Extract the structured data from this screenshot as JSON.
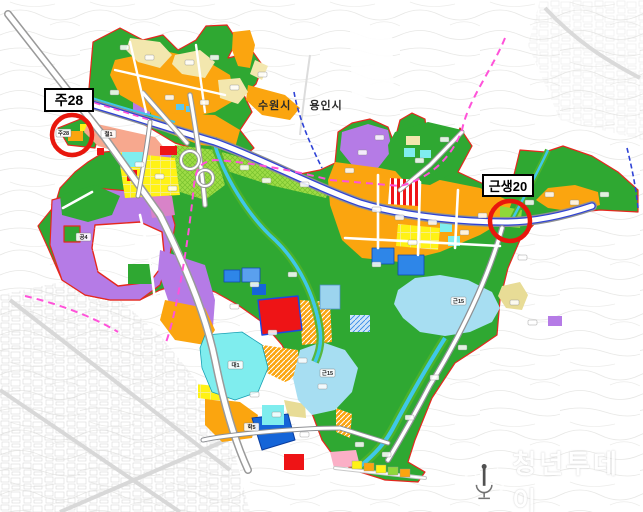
{
  "callouts": {
    "ju28": {
      "label": "주28"
    },
    "geunsaeng20": {
      "label": "근생20"
    }
  },
  "city_labels": {
    "left": "수원시",
    "right": "용인시"
  },
  "watermark": {
    "text": "청년투데이"
  },
  "zone_labels": [
    {
      "text": "철1",
      "x": 101,
      "y": 130
    },
    {
      "text": "주28",
      "x": 56,
      "y": 129
    },
    {
      "text": "공4",
      "x": 76,
      "y": 233
    },
    {
      "text": "근15",
      "x": 451,
      "y": 297
    },
    {
      "text": "근15",
      "x": 320,
      "y": 369
    },
    {
      "text": "대1",
      "x": 228,
      "y": 361
    },
    {
      "text": "학5",
      "x": 244,
      "y": 423
    }
  ],
  "palette": {
    "park_green": "#2FA832",
    "light_green": "#8FD83A",
    "orange_zone": "#FBA50F",
    "cream_zone": "#F3E7AE",
    "yellow_parcel": "#FFF215",
    "cyan_zone": "#7FEDEE",
    "lake_blue": "#A7DEF2",
    "school_blue": "#2E86E8",
    "deep_blue": "#1565D8",
    "purple_zone": "#B57BE6",
    "salmon_rail": "#F7A88E",
    "mauve_zone": "#D883C8",
    "pink_zone": "#FBAFC6",
    "red_parcel": "#EE1416",
    "boundary_red": "#E5281E",
    "planned_road_magenta": "#FF52D9",
    "city_boundary_blue": "#2F43D6",
    "stream_cyan": "#3FC8E8"
  }
}
